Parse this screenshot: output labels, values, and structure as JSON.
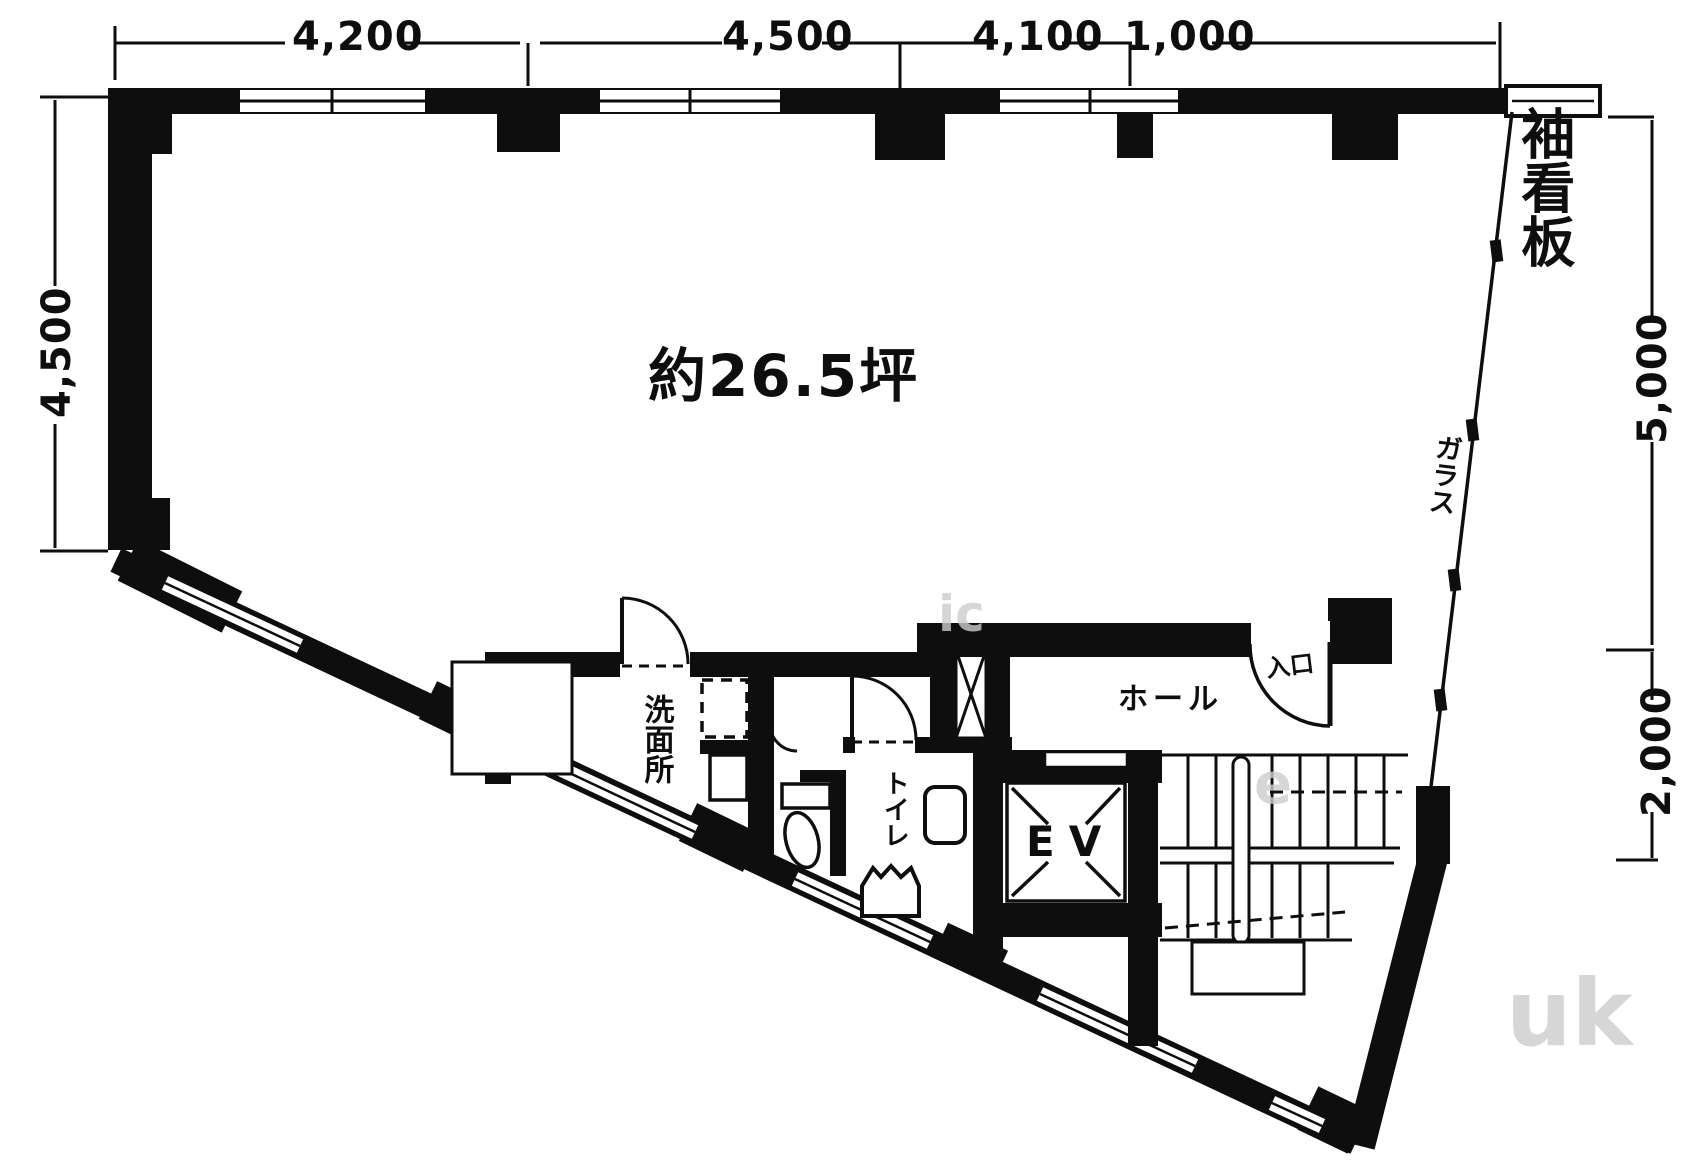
{
  "floorplan": {
    "area_label": "約26.5坪",
    "rooms": {
      "washroom": "洗面所",
      "toilet": "トイレ",
      "elevator": "EV",
      "hall": "ホール",
      "entrance": "入口"
    },
    "facade": {
      "sleeve_signboard": "袖看板",
      "glass": "ガラス"
    },
    "dimensions_mm": {
      "top": [
        "4,200",
        "4,500",
        "4,100",
        "1,000"
      ],
      "left": "4,500",
      "right_upper": "5,000",
      "right_lower": "2,000"
    },
    "watermark_fragments": [
      "ic",
      "e",
      "uk"
    ],
    "colors": {
      "ink": "#0e0e0e",
      "paper": "#ffffff",
      "watermark": "#cccccc"
    }
  }
}
